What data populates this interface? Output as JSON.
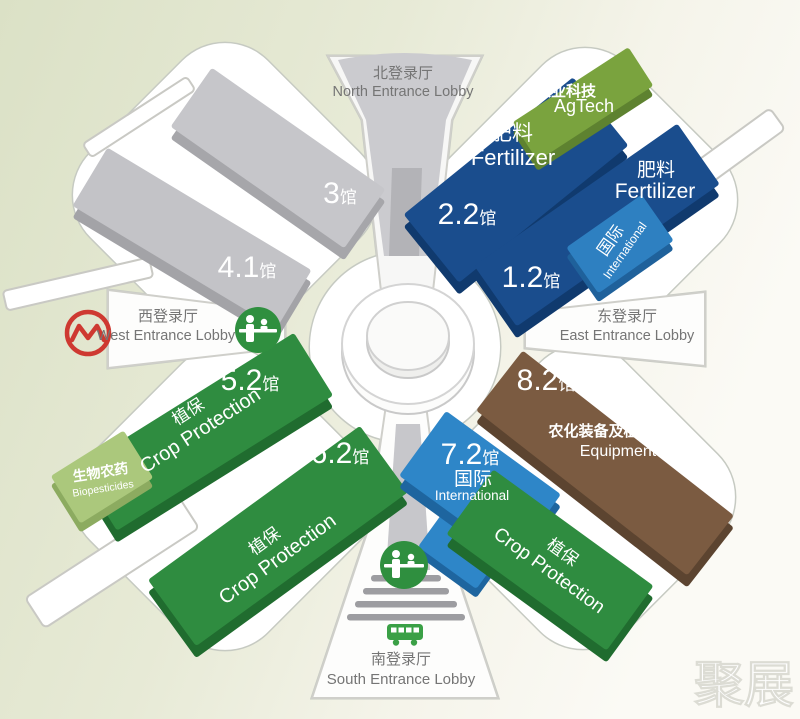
{
  "entrances": {
    "north": {
      "zh": "北登录厅",
      "en": "North Entrance Lobby"
    },
    "west": {
      "zh": "西登录厅",
      "en": "West Entrance Lobby"
    },
    "east": {
      "zh": "东登录厅",
      "en": "East Entrance Lobby"
    },
    "south": {
      "zh": "南登录厅",
      "en": "South Entrance Lobby"
    }
  },
  "halls": {
    "h3": {
      "num": "3",
      "suffix": "馆"
    },
    "h41": {
      "num": "4.1",
      "suffix": "馆"
    },
    "h22": {
      "num": "2.2",
      "suffix": "馆",
      "category_zh": "肥料",
      "category_en": "Fertilizer"
    },
    "h12": {
      "num": "1.2",
      "suffix": "馆",
      "category_zh": "肥料",
      "category_en": "Fertilizer",
      "sub_zh": "国际",
      "sub_en": "International"
    },
    "h52": {
      "num": "5.2",
      "suffix": "馆",
      "category_zh": "植保",
      "category_en": "Crop Protection",
      "sub_zh": "生物农药",
      "sub_en": "Biopesticides"
    },
    "h62": {
      "num": "6.2",
      "suffix": "馆",
      "category_zh": "植保",
      "category_en": "Crop Protection"
    },
    "h72": {
      "num": "7.2",
      "suffix": "馆",
      "category_zh": "国际",
      "category_en": "International",
      "adjacent_zh": "植保",
      "adjacent_en": "Crop Protection"
    },
    "h82": {
      "num": "8.2",
      "suffix": "馆",
      "category_zh": "农化装备及植保器械",
      "category_en": "Equipment"
    }
  },
  "zones": {
    "agtech": {
      "zh": "农业科技",
      "en": "AgTech"
    }
  },
  "icons": {
    "metro": "shanghai-metro-logo",
    "registration": "registration-counter",
    "bus": "shuttle-bus",
    "steps": "entrance-steps"
  },
  "colors": {
    "fertilizer_blue": "#1a4d8d",
    "international_blue": "#2e86c8",
    "crop_protection_green": "#2f8c40",
    "biopesticides_green": "#abc87c",
    "agtech_green": "#7aa33e",
    "equipment_brown": "#7b5b41",
    "hall_gray": "#c6c6ca",
    "metro_red": "#ce3931",
    "icon_green": "#2f8f3f"
  },
  "watermark": {
    "text": "聚展"
  }
}
